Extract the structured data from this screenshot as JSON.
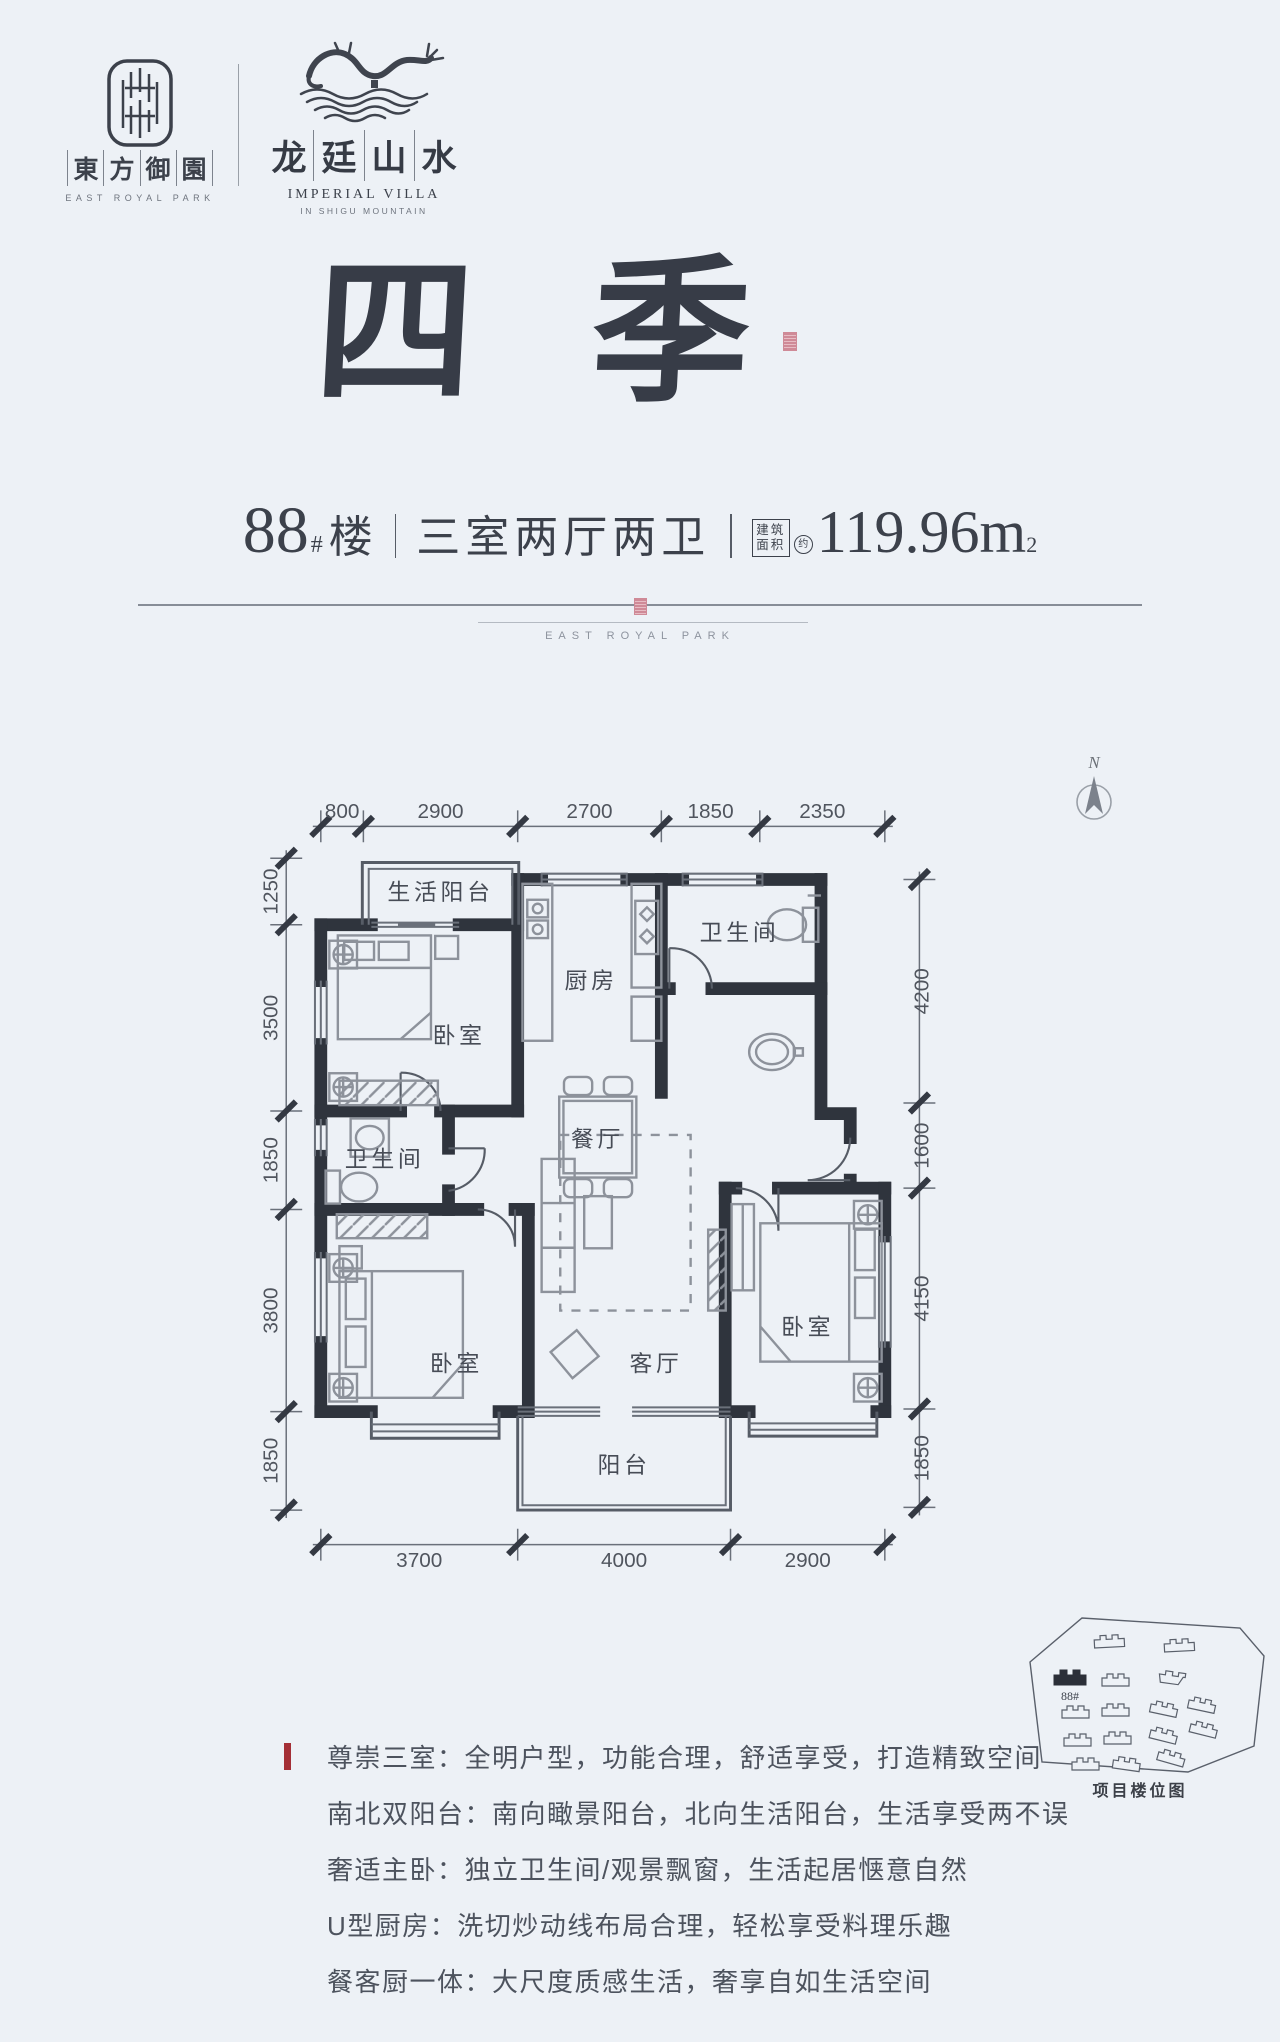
{
  "brand": {
    "left": {
      "cn_chars": [
        "東",
        "方",
        "御",
        "園"
      ],
      "en": "EAST ROYAL PARK"
    },
    "right": {
      "cn_chars": [
        "龙",
        "廷",
        "山",
        "水"
      ],
      "en1": "IMPERIAL VILLA",
      "en2": "IN SHIGU MOUNTAIN"
    }
  },
  "title": {
    "calligraphy": "四季"
  },
  "spec": {
    "building_no": "88",
    "hash": "#",
    "building_unit": "楼",
    "layout": "三室两厅两卫",
    "area_label_1": "建筑",
    "area_label_2": "面积",
    "approx": "约",
    "area_value": "119.96m",
    "area_sup": "2"
  },
  "divider": {
    "en": "EAST ROYAL PARK"
  },
  "floorplan": {
    "north_label": "N",
    "rooms": {
      "life_balcony": "生活阳台",
      "kitchen": "厨房",
      "bath_top": "卫生间",
      "dining": "餐厅",
      "bedroom_nw": "卧室",
      "bath_left": "卫生间",
      "bedroom_sw": "卧室",
      "living": "客厅",
      "bedroom_se": "卧室",
      "balcony_south": "阳台"
    },
    "dims": {
      "top": [
        "800",
        "2900",
        "2700",
        "1850",
        "2350"
      ],
      "left": [
        "1250",
        "3500",
        "1850",
        "3800",
        "1850"
      ],
      "right": [
        "4200",
        "1600",
        "4150",
        "1850"
      ],
      "bottom": [
        "3700",
        "4000",
        "2900"
      ]
    }
  },
  "siteplan": {
    "highlight_label": "88#",
    "caption": "项目楼位图"
  },
  "features": [
    "尊崇三室：全明户型，功能合理，舒适享受，打造精致空间",
    "南北双阳台：南向瞰景阳台，北向生活阳台，生活享受两不误",
    "奢适主卧：独立卫生间/观景飘窗，生活起居惬意自然",
    "U型厨房：洗切炒动线布局合理，轻松享受料理乐趣",
    "餐客厨一体：大尺度质感生活，奢享自如生活空间"
  ]
}
